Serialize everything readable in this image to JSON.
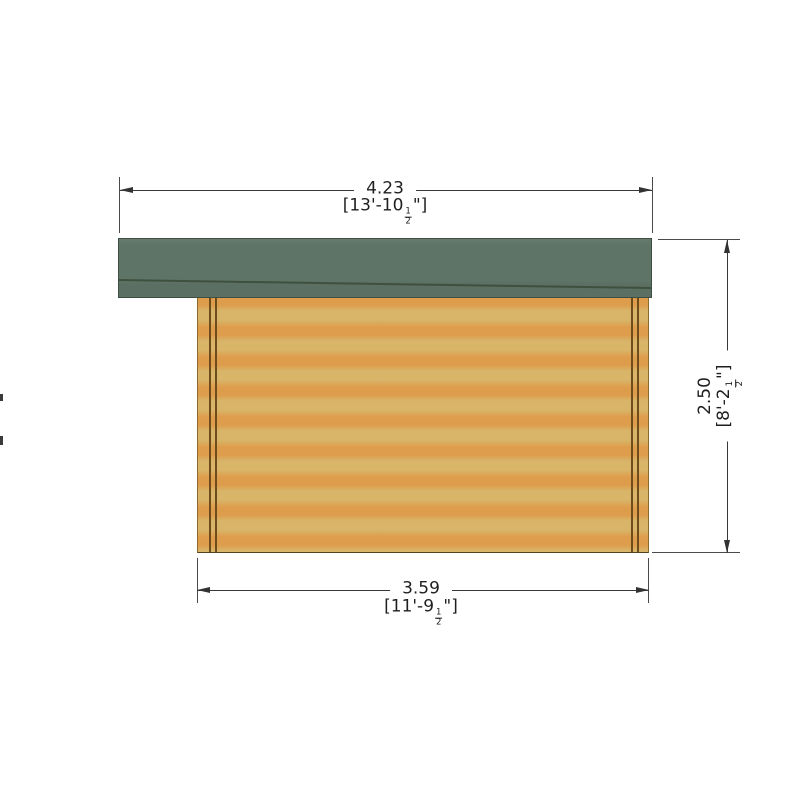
{
  "drawing": {
    "subject": "log-cabin-side-elevation",
    "background_color": "#ffffff",
    "colors": {
      "roof_green": "#5e7466",
      "roof_outline": "#3f4e43",
      "roof_fascia_line": "#40503e",
      "wall_light_band": "#d8b569",
      "wall_orange_band": "#de9d4c",
      "corner_joint_brown": "#6f4c1c",
      "dimension_line": "#383838",
      "dimension_text": "#1f1f1f"
    },
    "dimensions": {
      "top": {
        "metric": "4.23",
        "imperial_prefix": "[13'-10",
        "fraction_numerator": "1",
        "fraction_denominator": "2",
        "imperial_suffix": "\"]"
      },
      "bottom": {
        "metric": "3.59",
        "imperial_prefix": "[11'-9",
        "fraction_numerator": "1",
        "fraction_denominator": "2",
        "imperial_suffix": "\"]"
      },
      "right": {
        "metric": "2.50",
        "imperial_prefix": "[8'-2",
        "fraction_numerator": "1",
        "fraction_denominator": "2",
        "imperial_suffix": "\"]"
      }
    }
  }
}
